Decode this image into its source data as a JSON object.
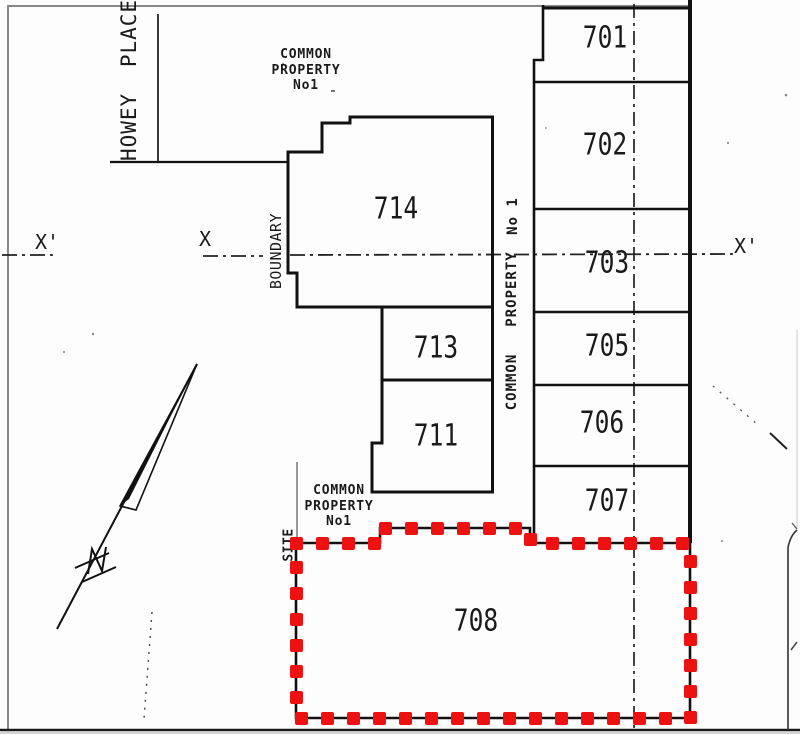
{
  "plan": {
    "street_label": "HOWEY PLACE",
    "boundary_label": "BOUNDARY",
    "site_label": "SITE",
    "section_markers": {
      "left": "X'",
      "mid": "X",
      "right": "X'"
    },
    "common_property_top": {
      "line1": "COMMON",
      "line2": "PROPERTY",
      "line3": "No1"
    },
    "common_property_strip": {
      "word_top": "No 1",
      "word_middle": "PROPERTY",
      "word_bottom": "COMMON"
    },
    "common_property_lower": {
      "line1": "COMMON",
      "line2": "PROPERTY",
      "line3": "No1"
    },
    "highlighted_lot": "708",
    "colors": {
      "highlight": "#ee1111",
      "line": "#1a1a1a"
    },
    "lots": [
      {
        "number": "701",
        "cx": 605,
        "cy": 38
      },
      {
        "number": "702",
        "cx": 605,
        "cy": 145
      },
      {
        "number": "703",
        "cx": 607,
        "cy": 263
      },
      {
        "number": "705",
        "cx": 607,
        "cy": 346
      },
      {
        "number": "706",
        "cx": 602,
        "cy": 423
      },
      {
        "number": "707",
        "cx": 607,
        "cy": 501
      },
      {
        "number": "708",
        "cx": 476,
        "cy": 621
      },
      {
        "number": "711",
        "cx": 436,
        "cy": 436
      },
      {
        "number": "713",
        "cx": 436,
        "cy": 348
      },
      {
        "number": "714",
        "cx": 396,
        "cy": 209
      }
    ],
    "highlight_outline": {
      "path": [
        [
          296,
          543
        ],
        [
          380,
          543
        ],
        [
          380,
          528
        ],
        [
          530,
          528
        ],
        [
          530,
          543
        ],
        [
          690,
          543
        ],
        [
          690,
          718
        ],
        [
          296,
          718
        ],
        [
          296,
          543
        ]
      ],
      "square_size": 13,
      "spacing": 26
    }
  }
}
